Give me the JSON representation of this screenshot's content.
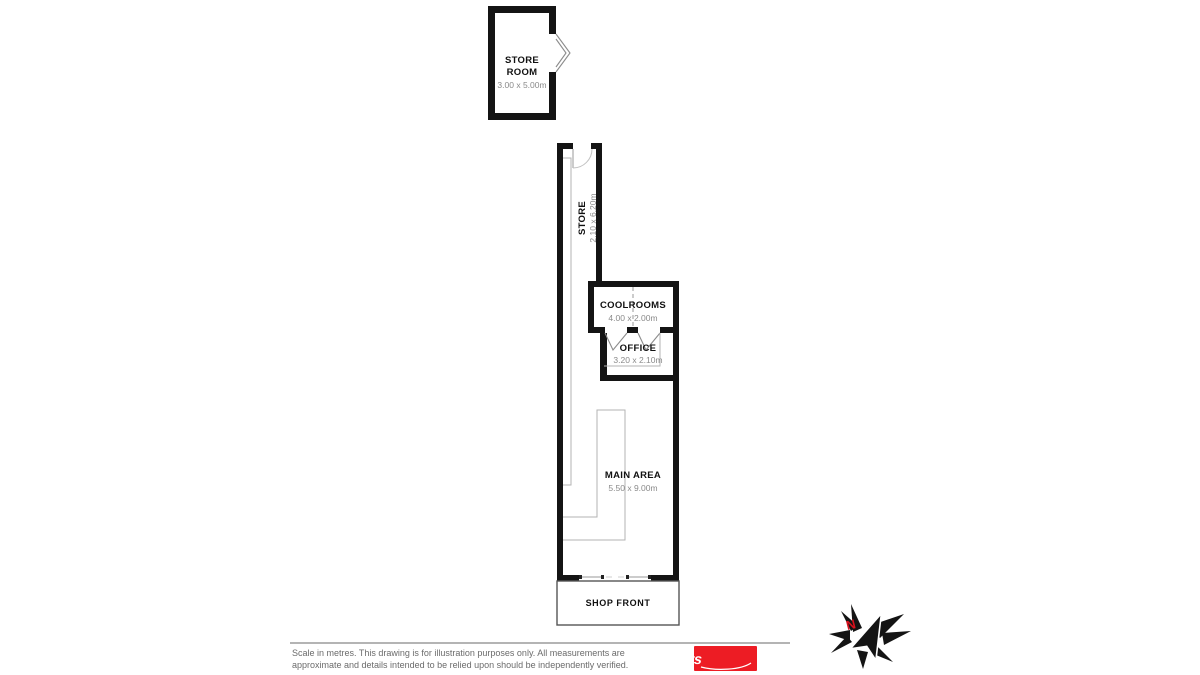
{
  "plan": {
    "store_room": {
      "name_line1": "STORE",
      "name_line2": "ROOM",
      "dims": "3.00 x 5.00m"
    },
    "store": {
      "name": "STORE",
      "dims": "2.10 x 6.20m"
    },
    "coolrooms": {
      "name": "COOLROOMS",
      "dims": "4.00 x 2.00m"
    },
    "office": {
      "name": "OFFICE",
      "dims": "3.20 x 2.10m"
    },
    "main_area": {
      "name": "MAIN AREA",
      "dims": "5.50 x 9.00m"
    },
    "shop_front": {
      "label": "SHOP FRONT"
    }
  },
  "compass": {
    "north_label": "N"
  },
  "footer": {
    "disclaimer_line1": "Scale in metres. This drawing is for illustration purposes only. All measurements are",
    "disclaimer_line2": "approximate and details intended to be relied upon should be independently verified.",
    "logo_text": "Elders"
  },
  "colors": {
    "wall": "#141414",
    "fixture_gray": "#b3b3b3",
    "dim_text_gray": "#8a8a8a",
    "logo_red": "#ed1c24",
    "north_red": "#d8101d"
  }
}
